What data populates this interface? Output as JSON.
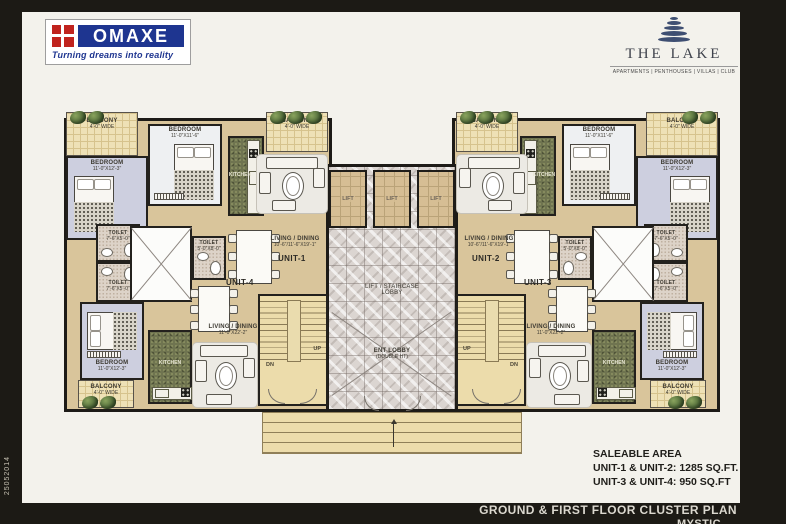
{
  "branding": {
    "omaxe_name": "OMAXE",
    "omaxe_tagline": "Turning dreams into reality",
    "project_name": "THE LAKE",
    "project_subtitle": "APARTMENTS | PENTHOUSES | VILLAS | CLUB"
  },
  "saleable_area": {
    "title": "SALEABLE AREA",
    "unit_1_2": "UNIT-1 & UNIT-2: 1285 SQ.FT.",
    "unit_3_4": "UNIT-3 & UNIT-4: 950 SQ.FT"
  },
  "footer": {
    "plan_title": "GROUND & FIRST FLOOR CLUSTER PLAN",
    "plan_subtitle": "MYSTIC",
    "side_code": "25052014"
  },
  "plan": {
    "units": {
      "u1": "UNIT-1",
      "u2": "UNIT-2",
      "u3": "UNIT-3",
      "u4": "UNIT-4"
    },
    "rooms": {
      "bedroom": "BEDROOM",
      "bedroom_dim_main": "11'-0\"X12'-3\"",
      "bedroom_dim_second": "11'-0\"X11'-6\"",
      "balcony": "BALCONY",
      "balcony_dim": "4'-0\" WIDE",
      "toilet": "TOILET",
      "toilet_dim_a": "7'-6\"X5'-0\"",
      "toilet_dim_b": "5'-0\"X8'-0\"",
      "kitchen": "KITCHEN",
      "living": "LIVING / DINING",
      "living_dim_large": "10'-6\"/11'-6\"X19'-1\"",
      "living_dim_small": "11'-0\"X22'-2\"",
      "lift": "LIFT",
      "lobby_line1": "LIFT / STAIRCASE",
      "lobby_line2": "LOBBY",
      "ent_line1": "ENT LOBBY",
      "ent_line2": "(DOUBLE HT)",
      "up": "UP",
      "dn": "DN"
    }
  },
  "colors": {
    "brand_blue": "#1e3590",
    "brand_red": "#c0231e",
    "logo_navy": "#3e4f72",
    "wall": "#1d1b17",
    "floor_tan": "#d9c59b",
    "floor_bedroom": "#cdcfdf",
    "floor_balcony": "#eee1b6",
    "floor_kitchen": "#6f7450",
    "floor_marble": "#dbd5d1",
    "floor_lift": "#d6be94",
    "frame_black": "#1c1a15"
  }
}
